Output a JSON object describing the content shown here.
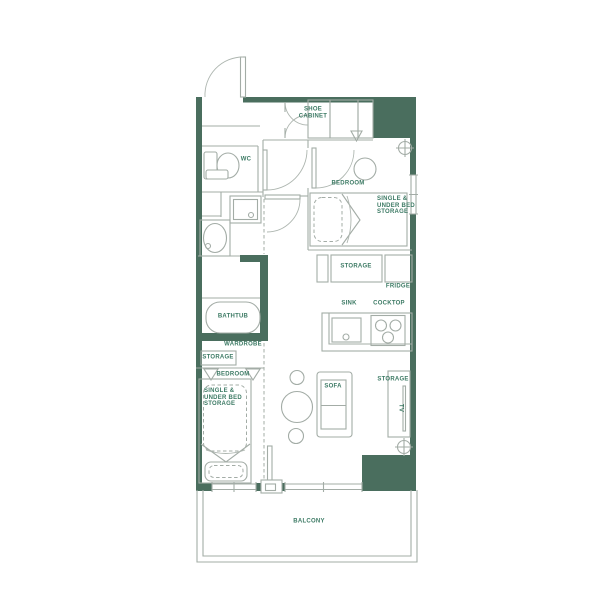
{
  "plan": {
    "title": "studio-apartment-floor-plan",
    "colors": {
      "wall": "#4A6E5E",
      "line": "#A3ACA6",
      "label": "#3C7A64",
      "background": "#FFFFFF"
    },
    "labels": {
      "shoe_cabinet": "SHOE\nCABINET",
      "wc": "WC",
      "bedroom_top": "BEDROOM",
      "single_under_bed_top": "SINGLE &\nUNDER BED\nSTORAGE",
      "storage_kitchen": "STORAGE",
      "fridge": "FRIDGE",
      "sink": "SINK",
      "cocktop": "COCKTOP",
      "bathtub": "BATHTUB",
      "wardrobe": "WARDROBE",
      "storage_wardrobe": "STORAGE",
      "bedroom_bottom": "BEDROOM",
      "single_under_bed_bottom": "SINGLE &\nUNDER BED\nSTORAGE",
      "sofa": "SOFA",
      "storage_tv": "STORAGE",
      "tv": "TV",
      "balcony": "BALCONY"
    }
  }
}
